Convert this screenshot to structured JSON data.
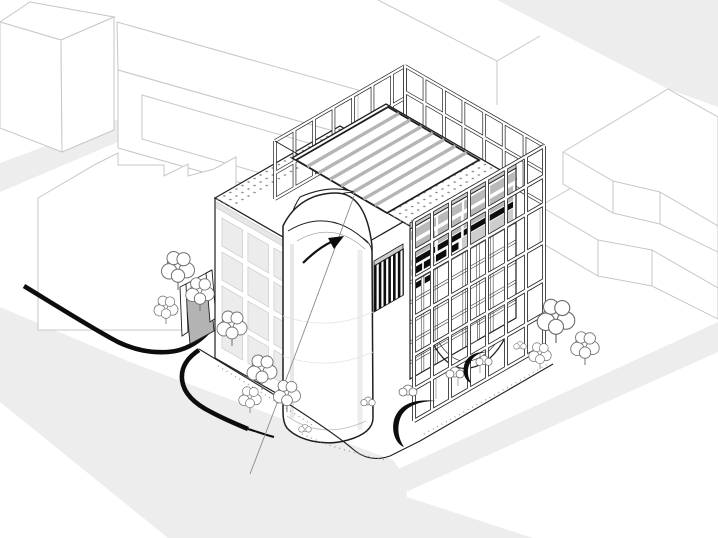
{
  "colors": {
    "background": "#ffffff",
    "line_main": "#1f1f1f",
    "line_context": "#c7c7c7",
    "street": "#ededed",
    "panel_gray": "#b9b9b9",
    "panel_mid": "#cdcdcd",
    "accent_black": "#0d0d0d",
    "ramp_gray": "#b3b3b3",
    "stripe_gray": "#b5b5b5",
    "dot_gray": "#8f8f8f",
    "tree_line": "#6f6f6f",
    "frame_white": "#ffffff"
  },
  "scene": {
    "counts": {
      "trees": 10,
      "bushes": 6,
      "flow_arrows": 2,
      "roof_stripes": 7,
      "frame_columns": 8,
      "frame_rails": 7,
      "facade_window_rows": 5,
      "facade_window_columns": 7
    }
  }
}
